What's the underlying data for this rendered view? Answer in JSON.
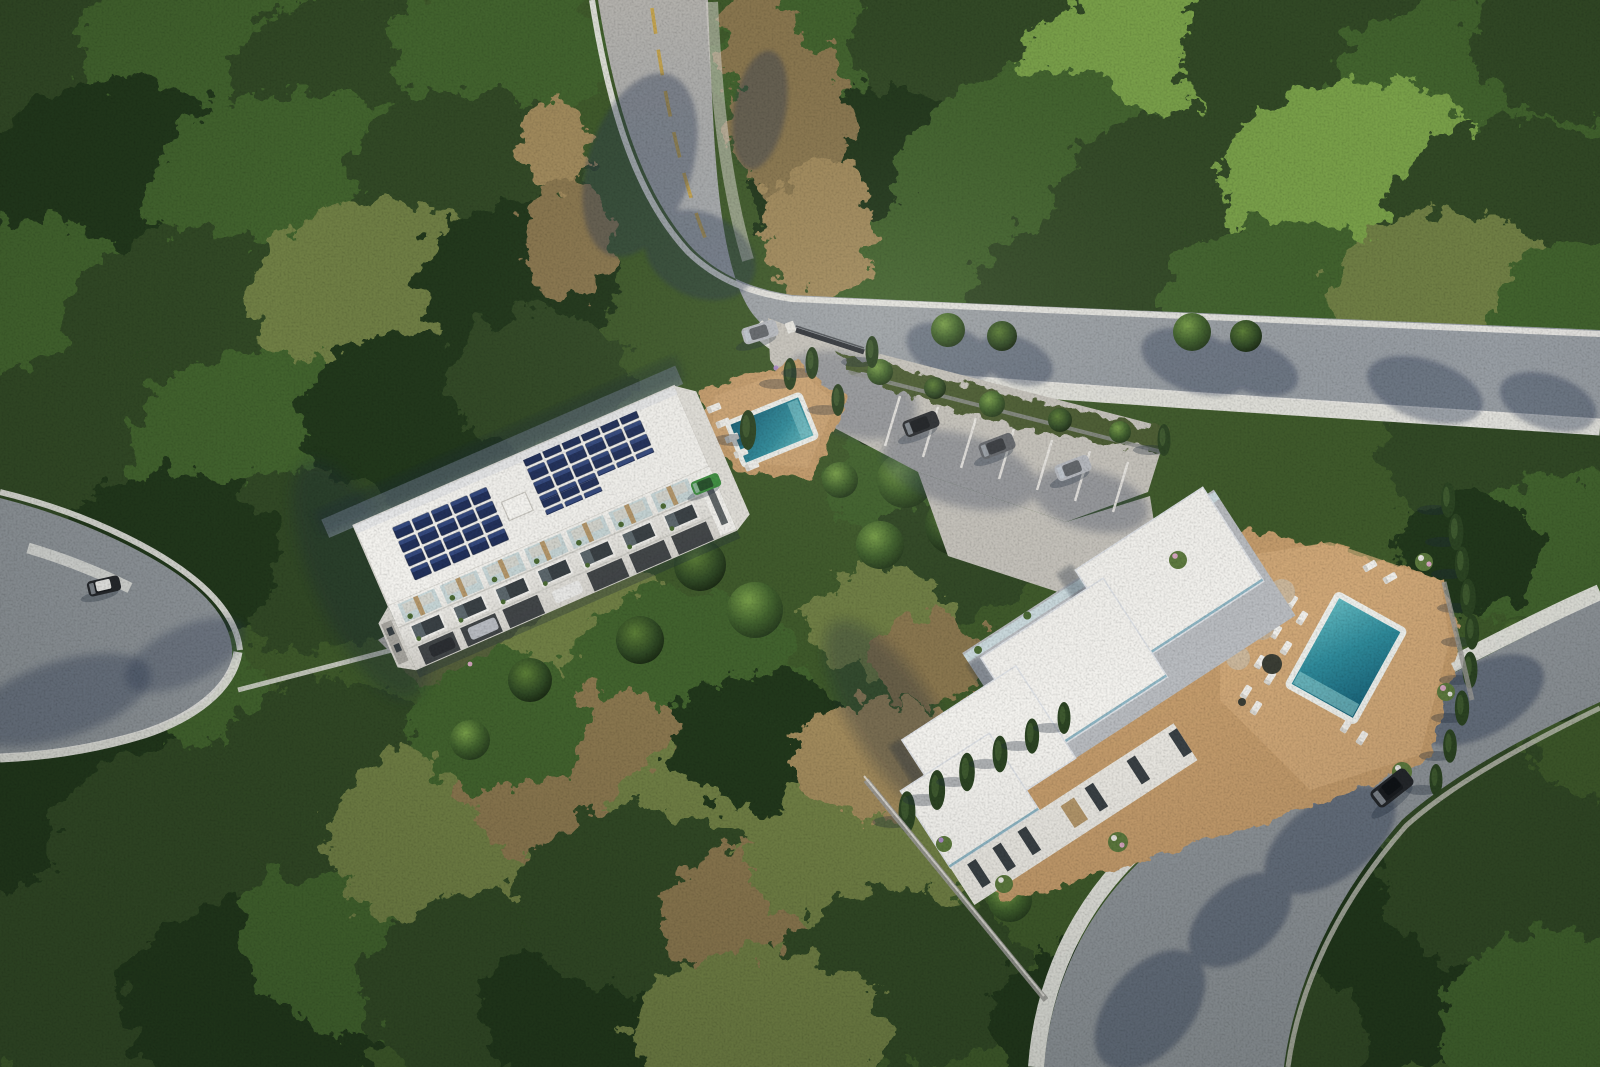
{
  "scene": {
    "description": "Aerial 3D architectural rendering of a hillside residential development surrounded by dense Mediterranean forest: a three-storey apartment block with rooftop solar panels and a communal pool on the left, a modern white flat-roofed villa with a private turquoise pool and timber sun deck on the right, linked by winding asphalt roads with white kerbs, a gated entrance drive and marked guest parking.",
    "setting": "dense evergreen forest and dry scrubland clearing on a hillside",
    "lighting": {
      "sun": "from the upper right",
      "shadows": "long shadows cast toward the lower left"
    },
    "roads": [
      {
        "name": "main road",
        "detail": "enters from top, curves east toward right edge, yellow centre line, white kerbs, wide white pavement on lower side"
      },
      {
        "name": "south-east road",
        "detail": "runs from right edge diagonally to bottom edge, wide white pavement on upper side"
      },
      {
        "name": "western cul-de-sac",
        "detail": "turning area at left edge with white kerb island and one parked car"
      },
      {
        "name": "entrance driveway",
        "detail": "gated entrance off the main road bend leading to guest parking with six marked bays, three occupied"
      }
    ],
    "buildings": [
      {
        "name": "apartment block",
        "storeys": 3,
        "roof": "flat white roof with two photovoltaic solar arrays (about 34 dark blue panels) and a skylight",
        "features": [
          "glass balconies with planters",
          "timber slat accents",
          "ground-floor carports with parked cars",
          "communal pool with timber deck and five sun loungers",
          "cypress trees",
          "flower beds along the front walkway"
        ]
      },
      {
        "name": "modern villa",
        "storeys": 2,
        "roof": "staggered flat white roof volumes with glass balustrade edges and roof planters",
        "features": [
          "private turquoise pool with white surround",
          "terracotta timber sun deck",
          "about ten sun loungers and four parasols",
          "cypress-lined boundaries",
          "flowering shrubs",
          "grey retaining garden walls"
        ]
      }
    ],
    "pools": [
      {
        "location": "apartment courtyard",
        "color": "teal"
      },
      {
        "location": "villa terrace",
        "color": "turquoise"
      }
    ],
    "vehicles": [
      {
        "type": "car",
        "color": "silver",
        "location": "at the entrance gate on the main road"
      },
      {
        "type": "car",
        "color": "dark grey",
        "location": "guest parking bay 1"
      },
      {
        "type": "car",
        "color": "grey",
        "location": "guest parking bay 2"
      },
      {
        "type": "car",
        "color": "silver",
        "location": "guest parking bay 3"
      },
      {
        "type": "car",
        "color": "green",
        "location": "beside the apartment pool deck"
      },
      {
        "type": "car",
        "color": "silver",
        "location": "apartment carport"
      },
      {
        "type": "car",
        "color": "white",
        "location": "apartment carport"
      },
      {
        "type": "car",
        "color": "dark",
        "location": "apartment carport, left bay"
      },
      {
        "type": "car",
        "color": "black with white roof",
        "location": "western cul-de-sac"
      },
      {
        "type": "SUV",
        "color": "black",
        "location": "driving on the south-east road"
      }
    ],
    "vegetation": {
      "forest": "dense green canopy, darker and taller at top right and bottom left",
      "clearing": "olive and brown dry scrub between the two buildings",
      "ornamental": "cypress columns, flowering shrubs in purple, pink and white"
    }
  },
  "palette": {
    "forest-base": "#3f5a2b",
    "forest-deep": "#24381d",
    "forest-dark": "#304a25",
    "forest-mid": "#42632e",
    "forest-light": "#5d8038",
    "forest-olive": "#6f7f44",
    "forest-bright": "#79a04a",
    "scrub-brown": "#8a7750",
    "scrub-tan": "#a18a5c",
    "asphalt": "#a3a7ab",
    "asphalt-dark": "#8e9499",
    "concrete": "#c6c3bc",
    "kerb-white": "#e9e8e4",
    "stall-white": "#eceae6",
    "line-yellow": "#c8a23f",
    "roof-white": "#f3f2ee",
    "facade-white": "#eae8e2",
    "facade-shade": "#d5d3cd",
    "wall-gray": "#97999a",
    "wood-accent": "#b4976b",
    "glass-dark": "#3a4145",
    "balcony-glass": "#a7c3c9",
    "solar-navy": "#22315b",
    "solar-blue": "#3a5088",
    "pool-deep": "#155d74",
    "pool-mid": "#2f8b9b",
    "pool-shallow": "#66bcc2",
    "pool-rim": "#eef0ec",
    "deck-tan": "#c49c6c",
    "deck-light": "#d4ac7c",
    "cypress": "#2c4423",
    "cast-shadow": "#1e2b3a",
    "road-shadow": "#2c3952",
    "gate-metal": "#30343a",
    "car-dark": "#2c2f33",
    "car-grey": "#66696e",
    "car-silver": "#b7bac0",
    "car-white": "#e9e9e7",
    "car-green": "#3e8f41",
    "flower-purple": "#a98bc4",
    "flower-pink": "#d8a7c2",
    "flower-white": "#e9e7e3"
  }
}
